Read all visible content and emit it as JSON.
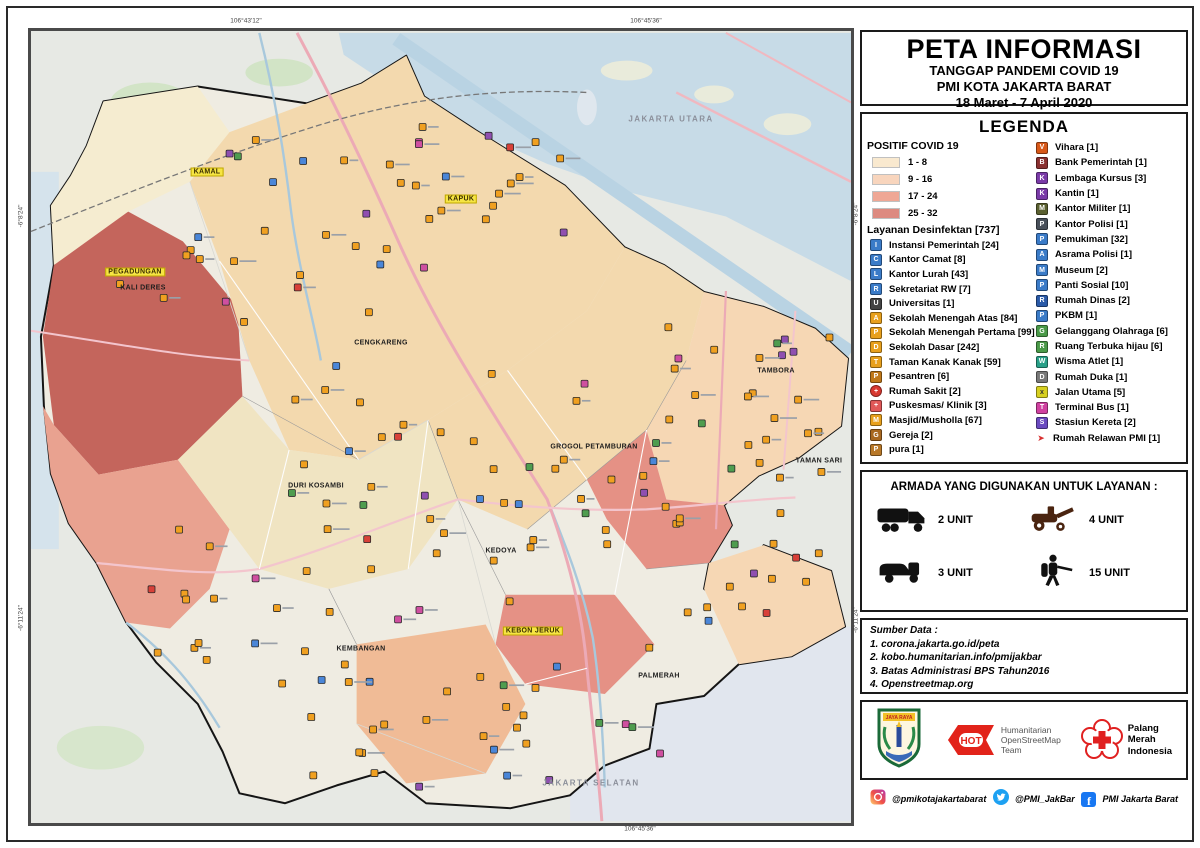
{
  "title": {
    "main": "PETA INFORMASI",
    "sub1": "TANGGAP PANDEMI COVID 19",
    "sub2": "PMI KOTA JAKARTA BARAT",
    "sub3": "18 Maret - 7 April 2020"
  },
  "legend": {
    "heading": "LEGENDA",
    "covid": {
      "heading": "POSITIF COVID 19",
      "classes": [
        {
          "range": "1 - 8",
          "color": "#f9e9cf"
        },
        {
          "range": "9 - 16",
          "color": "#f8d5bd"
        },
        {
          "range": "17 - 24",
          "color": "#efa795"
        },
        {
          "range": "25 - 32",
          "color": "#dd8a80"
        }
      ]
    },
    "desinfektan_heading": "Layanan Desinfektan [737]",
    "facilities_left": [
      {
        "label": "Instansi Pemerintah [24]",
        "color": "#3a7bc8",
        "glyph": "I"
      },
      {
        "label": "Kantor Camat [8]",
        "color": "#3a7bc8",
        "glyph": "C"
      },
      {
        "label": "Kantor Lurah [43]",
        "color": "#3a7bc8",
        "glyph": "L"
      },
      {
        "label": "Sekretariat RW [7]",
        "color": "#3a7bc8",
        "glyph": "R"
      },
      {
        "label": "Universitas [1]",
        "color": "#444444",
        "glyph": "U"
      },
      {
        "label": "Sekolah Menengah Atas [84]",
        "color": "#e8a01c",
        "glyph": "A"
      },
      {
        "label": "Sekolah Menengah Pertama [99]",
        "color": "#e8a01c",
        "glyph": "P"
      },
      {
        "label": "Sekolah Dasar [242]",
        "color": "#e8a01c",
        "glyph": "D"
      },
      {
        "label": "Taman Kanak Kanak [59]",
        "color": "#e8a01c",
        "glyph": "T"
      },
      {
        "label": "Pesantren  [6]",
        "color": "#c07818",
        "glyph": "P"
      },
      {
        "label": "Rumah Sakit [2]",
        "color": "#d83830",
        "glyph": "+",
        "shape": "circle"
      },
      {
        "label": "Puskesmas/ Klinik [3]",
        "color": "#e05858",
        "glyph": "+"
      },
      {
        "label": "Masjid/Musholla [67]",
        "color": "#e8a01c",
        "glyph": "M"
      },
      {
        "label": "Gereja [2]",
        "color": "#a86820",
        "glyph": "G"
      },
      {
        "label": "pura [1]",
        "color": "#b87828",
        "glyph": "P"
      }
    ],
    "facilities_right": [
      {
        "label": "Vihara [1]",
        "color": "#d85818",
        "glyph": "V"
      },
      {
        "label": "Bank Pemerintah [1]",
        "color": "#8a3030",
        "glyph": "B"
      },
      {
        "label": "Lembaga Kursus [3]",
        "color": "#7a3aa8",
        "glyph": "K"
      },
      {
        "label": "Kantin [1]",
        "color": "#7a3aa8",
        "glyph": "K"
      },
      {
        "label": "Kantor Militer [1]",
        "color": "#5a6030",
        "glyph": "M"
      },
      {
        "label": "Kantor Polisi [1]",
        "color": "#48505a",
        "glyph": "P"
      },
      {
        "label": "Pemukiman  [32]",
        "color": "#3a7bc8",
        "glyph": "P"
      },
      {
        "label": "Asrama Polisi [1]",
        "color": "#3a7bc8",
        "glyph": "A"
      },
      {
        "label": "Museum  [2]",
        "color": "#3a7bc8",
        "glyph": "M"
      },
      {
        "label": "Panti Sosial [10]",
        "color": "#3a7bc8",
        "glyph": "P"
      },
      {
        "label": "Rumah Dinas [2]",
        "color": "#2a5aa8",
        "glyph": "R"
      },
      {
        "label": "PKBM  [1]",
        "color": "#3a7bc8",
        "glyph": "P"
      },
      {
        "label": "Gelanggang Olahraga [6]",
        "color": "#4a9a48",
        "glyph": "G"
      },
      {
        "label": "Ruang Terbuka hijau [6]",
        "color": "#4a9a48",
        "glyph": "R"
      },
      {
        "label": "Wisma Atlet [1]",
        "color": "#28a088",
        "glyph": "W"
      },
      {
        "label": "Rumah Duka [1]",
        "color": "#787878",
        "glyph": "D"
      },
      {
        "label": "Jalan Utama [5]",
        "color": "#d8d020",
        "glyph": "x",
        "dark_glyph": true
      },
      {
        "label": "Terminal Bus [1]",
        "color": "#d040a0",
        "glyph": "T"
      },
      {
        "label": "Stasiun Kereta  [2]",
        "color": "#6a4ac0",
        "glyph": "S"
      },
      {
        "label": "Rumah Relawan PMI [1]",
        "color": "#d83030",
        "glyph": "➤",
        "shape": "plain"
      }
    ]
  },
  "armada": {
    "heading": "ARMADA YANG DIGUNAKAN UNTUK LAYANAN :",
    "items": [
      {
        "name": "tank-truck",
        "count": "2 UNIT"
      },
      {
        "name": "spray-vehicle",
        "count": "4 UNIT"
      },
      {
        "name": "van-truck",
        "count": "3 UNIT"
      },
      {
        "name": "mist-blower",
        "count": "15 UNIT"
      }
    ]
  },
  "sumber": {
    "heading": "Sumber Data :",
    "items": [
      "1. corona.jakarta.go.id/peta",
      "2. kobo.humanitarian.info/pmijakbar",
      "3. Batas Administrasi BPS Tahun2016",
      "4. Openstreetmap.org"
    ]
  },
  "logos": {
    "jakarta_motto": "JAYA RAYA",
    "hot_line1": "Humanitarian",
    "hot_line2": "OpenStreetMap",
    "hot_line3": "Team",
    "hot_label": "HOT",
    "pmi_line1": "Palang",
    "pmi_line2": "Merah",
    "pmi_line3": "Indonesia"
  },
  "social": [
    {
      "network": "instagram",
      "handle": "@pmikotajakartabarat"
    },
    {
      "network": "twitter",
      "handle": "@PMI_JakBar"
    },
    {
      "network": "facebook",
      "handle": "PMI Jakarta Barat"
    }
  ],
  "map": {
    "labels": [
      {
        "text": "KAMAL",
        "x": 176,
        "y": 141,
        "style": "hl"
      },
      {
        "text": "KAPUK",
        "x": 430,
        "y": 168,
        "style": "hl"
      },
      {
        "text": "PEGADUNGAN",
        "x": 104,
        "y": 241,
        "style": "hl"
      },
      {
        "text": "KALI DERES",
        "x": 112,
        "y": 257,
        "style": ""
      },
      {
        "text": "CENGKARENG",
        "x": 350,
        "y": 312,
        "style": ""
      },
      {
        "text": "DURI KOSAMBI",
        "x": 285,
        "y": 455,
        "style": ""
      },
      {
        "text": "GROGOL PETAMBURAN",
        "x": 563,
        "y": 416,
        "style": ""
      },
      {
        "text": "TAMBORA",
        "x": 745,
        "y": 340,
        "style": ""
      },
      {
        "text": "TAMAN SARI",
        "x": 788,
        "y": 430,
        "style": ""
      },
      {
        "text": "KEDOYA",
        "x": 470,
        "y": 520,
        "style": ""
      },
      {
        "text": "KEMBANGAN",
        "x": 330,
        "y": 618,
        "style": ""
      },
      {
        "text": "KEBON JERUK",
        "x": 502,
        "y": 600,
        "style": "hl"
      },
      {
        "text": "PALMERAH",
        "x": 628,
        "y": 645,
        "style": ""
      },
      {
        "text": "JAKARTA UTARA",
        "x": 640,
        "y": 88,
        "style": "gray"
      },
      {
        "text": "JAKARTA SELATAN",
        "x": 560,
        "y": 752,
        "style": "gray"
      }
    ],
    "graticule": {
      "top": [
        {
          "x": 218,
          "label": "106°43'12\""
        },
        {
          "x": 618,
          "label": "106°45'36\""
        }
      ],
      "bottom": [
        {
          "x": 612,
          "label": "106°45'36\""
        }
      ],
      "left": [
        {
          "y": 188,
          "label": "-6°8'24\""
        },
        {
          "y": 590,
          "label": "-6°11'24\""
        }
      ],
      "right": [
        {
          "y": 186,
          "label": "-6°8'24\""
        },
        {
          "y": 592,
          "label": "-6°11'24\""
        }
      ]
    },
    "marker_palette": {
      "school_orange": "#f0a020",
      "government_blue": "#4a86d8",
      "sport_green": "#4f9d4f",
      "service_purple": "#8f4fb0",
      "health_red": "#d84038",
      "transport_magenta": "#cf4fa0"
    }
  }
}
